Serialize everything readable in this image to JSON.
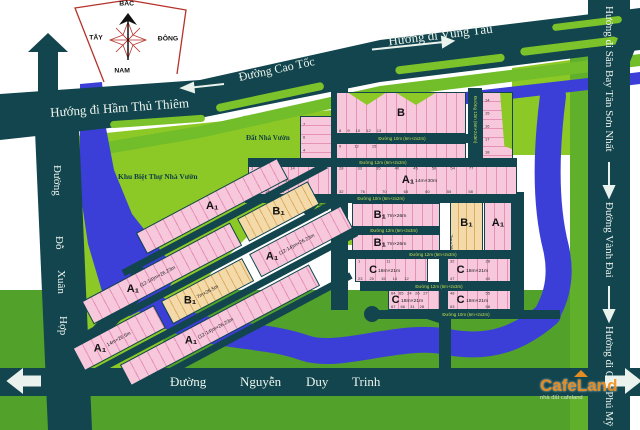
{
  "palette": {
    "road": "#12454e",
    "water": "#3b3fd8",
    "green_bright": "#8cc926",
    "green_mid": "#52a12b",
    "pink": "#f7c7db",
    "tan": "#f4d9a9",
    "street_label": "#c6df4f",
    "compass_red": "#b5332a",
    "watermark_orange": "#f6921e"
  },
  "compass": {
    "north": "BẮC",
    "south": "NAM",
    "west": "TÂY",
    "east": "ĐÔNG"
  },
  "roads": {
    "cao_toc": "Đường Cao Tốc",
    "thu_thiem": "Hướng đi Hầm Thủ Thiêm",
    "vung_tau": "Hướng đi Vũng Tàu",
    "san_bay": "Hướng đi Sân Bay Tân Sơn Nhất",
    "vanh_dai": "Đường Vành Đai",
    "cau_phu_my": "Hướng đi Cầu Phú Mỹ",
    "do_xuan_hop": {
      "w0": "Đường",
      "w1": "Đỗ",
      "w2": "Xuân",
      "w3": "Hợp"
    },
    "ndt": {
      "w0": "Đường",
      "w1": "Nguyễn",
      "w2": "Duy",
      "w3": "Trinh"
    }
  },
  "areas": {
    "villa": "Khu Biệt Thự Nhà Vườn",
    "garden": "Đất Nhà Vườn",
    "tree1": "Cây Xanh",
    "tree2": "Cây Xanh"
  },
  "streets": {
    "s1": "Đường 10m (6m+2x2m)",
    "s2": "Đường 12m (6m+2x3m)",
    "s3": "Đường 10m (6m+2x2m)",
    "s4": "Đường 12m (6m+2x3m)",
    "s5": "Đường 12m (6m+2x3m)",
    "s6": "Đường 12m (6m+2x3m)",
    "s7": "Đường 10m (6m+2x2m)",
    "sv": "Đường 12m (6m+2x3m)"
  },
  "blocks": {
    "strip": {
      "plots": "7\n6\n4\n1 3"
    },
    "b": {
      "label": "B",
      "plots_bottom": "8 9 10 12 13"
    },
    "a": {
      "label": "A",
      "dims": "17m×26.5m",
      "plots_top": "9 12 15",
      "plots_bottom": "1 8"
    },
    "c0": {
      "label": "C",
      "plots": "14\n15\n16\n17\n18",
      "plots_bottom": "1 2"
    },
    "a1l": {
      "label": "A₁",
      "dims": "14m×31m",
      "plots_top": "1 5 10 14",
      "plots_bottom": "25 20 17 32"
    },
    "a1w": {
      "label": "A₁",
      "dims": "14m×30m",
      "plots_top": "28 33 35 40 45 50 54 77",
      "plots_bottom": "32 76 70 65 60 55 58"
    },
    "b1a": {
      "label": "B₁",
      "dims": "7m×26m"
    },
    "b1b": {
      "label": "B₁",
      "dims": "7m×26m"
    },
    "b1t": {
      "label": "B₁",
      "dims": "7m×28m"
    },
    "a1c": {
      "label": "A₁",
      "dims": "18m×26m"
    },
    "c1": {
      "label": "C",
      "dims": "18m×21m",
      "plots_top": "1 11",
      "plots_bottom": "23 20 15 14 12"
    },
    "c2": {
      "label": "C",
      "dims": "18m×21m",
      "plots_top": "32 28",
      "plots_bottom": "47 40"
    },
    "c3": {
      "label": "C",
      "dims": "18m×21m",
      "plots_top": "64 65 24 26 27",
      "plots_bottom": "67 66 31 28"
    },
    "c4": {
      "label": "C",
      "dims": "18m×21m",
      "plots_top": "48 55",
      "plots_bottom": "63 58"
    },
    "d0": {
      "label": "A₁",
      "dims": ""
    },
    "d1": {
      "label": "A₁",
      "dims": "(12-14)m×26.23m"
    },
    "d2": {
      "label": "B₁",
      "dims": ""
    },
    "d3": {
      "label": "A₁",
      "dims": "14m×26.5m"
    },
    "d4": {
      "label": "B₁",
      "dims": "7m×26.5m"
    },
    "d5": {
      "label": "A₁",
      "dims": "(12-14)m×26.23m"
    },
    "d6": {
      "label": "A₁",
      "dims": "(12-14)m×26.23m"
    }
  },
  "watermark": {
    "brand": "CafeLand",
    "tagline": "nhà đất cafeland"
  }
}
